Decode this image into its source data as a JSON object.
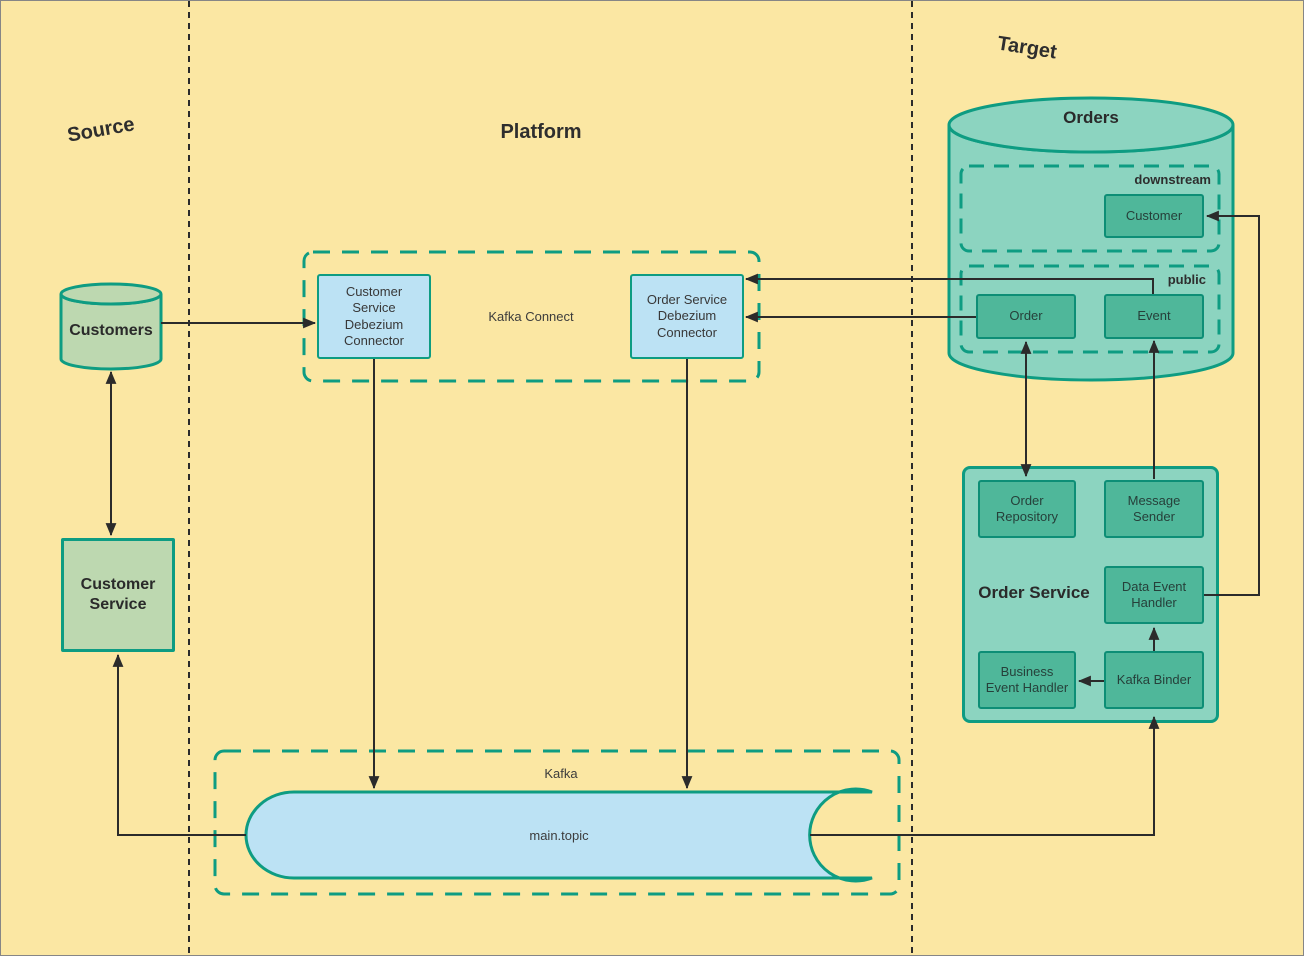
{
  "canvas": {
    "width": 1304,
    "height": 956
  },
  "colors": {
    "background": "#FBE7A3",
    "teal_stroke": "#0E9C82",
    "teal_fill": "#8CD4C0",
    "teal_box_fill": "#4FB79A",
    "teal_box_stroke": "#0D8E76",
    "blue_fill": "#BCE2F4",
    "green_fill": "#BDD8B0",
    "line": "#2B2B2B",
    "text_dark": "#2E2E2E",
    "canvas_border": "#868686"
  },
  "sections": {
    "source": {
      "label": "Source"
    },
    "platform": {
      "label": "Platform"
    },
    "target": {
      "label": "Target"
    }
  },
  "nodes": {
    "customers_db": {
      "label": "Customers",
      "type": "database"
    },
    "customer_service": {
      "label": "Customer Service",
      "type": "process"
    },
    "kafka_connect": {
      "label": "Kafka Connect",
      "type": "group"
    },
    "customer_service_debezium_connector": {
      "label": "Customer Service Debezium Connector",
      "type": "process"
    },
    "order_service_debezium_connector": {
      "label": "Order Service Debezium Connector",
      "type": "process"
    },
    "kafka": {
      "label": "Kafka",
      "type": "group"
    },
    "main_topic": {
      "label": "main.topic",
      "type": "queue"
    },
    "orders_db": {
      "label": "Orders",
      "type": "database"
    },
    "downstream_schema": {
      "label": "downstream",
      "type": "schema-group"
    },
    "customer_table": {
      "label": "Customer",
      "type": "table"
    },
    "public_schema": {
      "label": "public",
      "type": "schema-group"
    },
    "order_table": {
      "label": "Order",
      "type": "table"
    },
    "event_table": {
      "label": "Event",
      "type": "table"
    },
    "order_service": {
      "label": "Order Service",
      "type": "container"
    },
    "order_repository": {
      "label": "Order Repository",
      "type": "component"
    },
    "message_sender": {
      "label": "Message Sender",
      "type": "component"
    },
    "data_event_handler": {
      "label": "Data Event Handler",
      "type": "component"
    },
    "business_event_handler": {
      "label": "Business Event Handler",
      "type": "component"
    },
    "kafka_binder": {
      "label": "Kafka Binder",
      "type": "component"
    }
  },
  "edges": [
    {
      "id": "edge-customers-to-csdc",
      "from": "customers_db",
      "to": "customer_service_debezium_connector",
      "path": "M 160 322 L 314 322",
      "arrows": "end"
    },
    {
      "id": "edge-customers-customer-service",
      "from": "customers_db",
      "to": "customer_service",
      "path": "M 110 371 L 110 534",
      "arrows": "both"
    },
    {
      "id": "edge-csdc-to-main-topic",
      "from": "customer_service_debezium_connector",
      "to": "main_topic",
      "path": "M 373 358 L 373 787",
      "arrows": "end"
    },
    {
      "id": "edge-osdc-to-main-topic",
      "from": "order_service_debezium_connector",
      "to": "main_topic",
      "path": "M 686 358 L 686 787",
      "arrows": "end"
    },
    {
      "id": "edge-event-to-osdc",
      "from": "event_table",
      "to": "order_service_debezium_connector",
      "path": "M 1152 293 L 1152 278 L 745 278",
      "arrows": "end"
    },
    {
      "id": "edge-order-to-osdc",
      "from": "order_table",
      "to": "order_service_debezium_connector",
      "path": "M 975 316 L 745 316",
      "arrows": "end"
    },
    {
      "id": "edge-order-order-repository",
      "from": "order_table",
      "to": "order_repository",
      "path": "M 1025 341 L 1025 475",
      "arrows": "both"
    },
    {
      "id": "edge-message-sender-to-event",
      "from": "message_sender",
      "to": "event_table",
      "path": "M 1153 478 L 1153 340",
      "arrows": "end"
    },
    {
      "id": "edge-kafka-binder-to-data-event-handler",
      "from": "kafka_binder",
      "to": "data_event_handler",
      "path": "M 1153 650 L 1153 627",
      "arrows": "end"
    },
    {
      "id": "edge-kafka-binder-to-business-event-handler",
      "from": "kafka_binder",
      "to": "business_event_handler",
      "path": "M 1103 680 L 1078 680",
      "arrows": "end"
    },
    {
      "id": "edge-data-event-handler-to-customer",
      "from": "data_event_handler",
      "to": "customer_table",
      "path": "M 1203 594 L 1258 594 L 1258 215 L 1206 215",
      "arrows": "end"
    },
    {
      "id": "edge-main-topic-to-customer-service",
      "from": "main_topic",
      "to": "customer_service",
      "path": "M 245 834 L 117 834 L 117 654",
      "arrows": "end"
    },
    {
      "id": "edge-main-topic-to-kafka-binder",
      "from": "main_topic",
      "to": "kafka_binder",
      "path": "M 809 834 L 1153 834 L 1153 716",
      "arrows": "end"
    }
  ]
}
